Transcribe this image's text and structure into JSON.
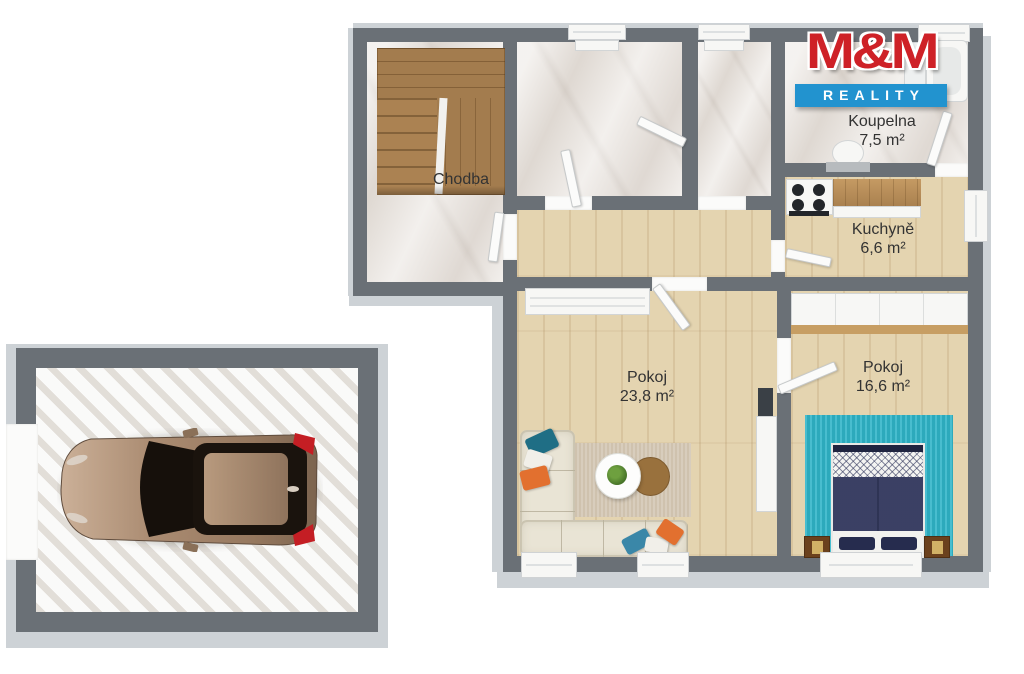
{
  "brand": {
    "name": "M&M",
    "tagline": "REALITY"
  },
  "rooms": {
    "chodba": {
      "label": "Chodba"
    },
    "koupelna": {
      "label": "Koupelna",
      "area": "7,5 m²"
    },
    "kuchyne": {
      "label": "Kuchyně",
      "area": "6,6 m²"
    },
    "pokoj_obyvaci": {
      "label": "Pokoj",
      "area": "23,8 m²"
    },
    "pokoj_loznice": {
      "label": "Pokoj",
      "area": "16,6 m²"
    }
  },
  "colors": {
    "wall": "#6a7076",
    "wall-light": "#cdd2d6",
    "marble": "#eae5e0",
    "wood": "#e4d4b0",
    "stairs": "#a37c4e",
    "counter-wood": "#b98c59",
    "teal-rug": "#2fb4c8",
    "bed-navy": "#2a3057",
    "sofa": "#e9e4d5",
    "rug-beige": "#cfc2ae",
    "logo-red": "#ce2127",
    "logo-blue": "#2293cf",
    "car-bronze": "#a8896f",
    "pillow-teal": "#1f6e85",
    "pillow-blue": "#3a87a8",
    "pillow-orange": "#e2702f"
  }
}
